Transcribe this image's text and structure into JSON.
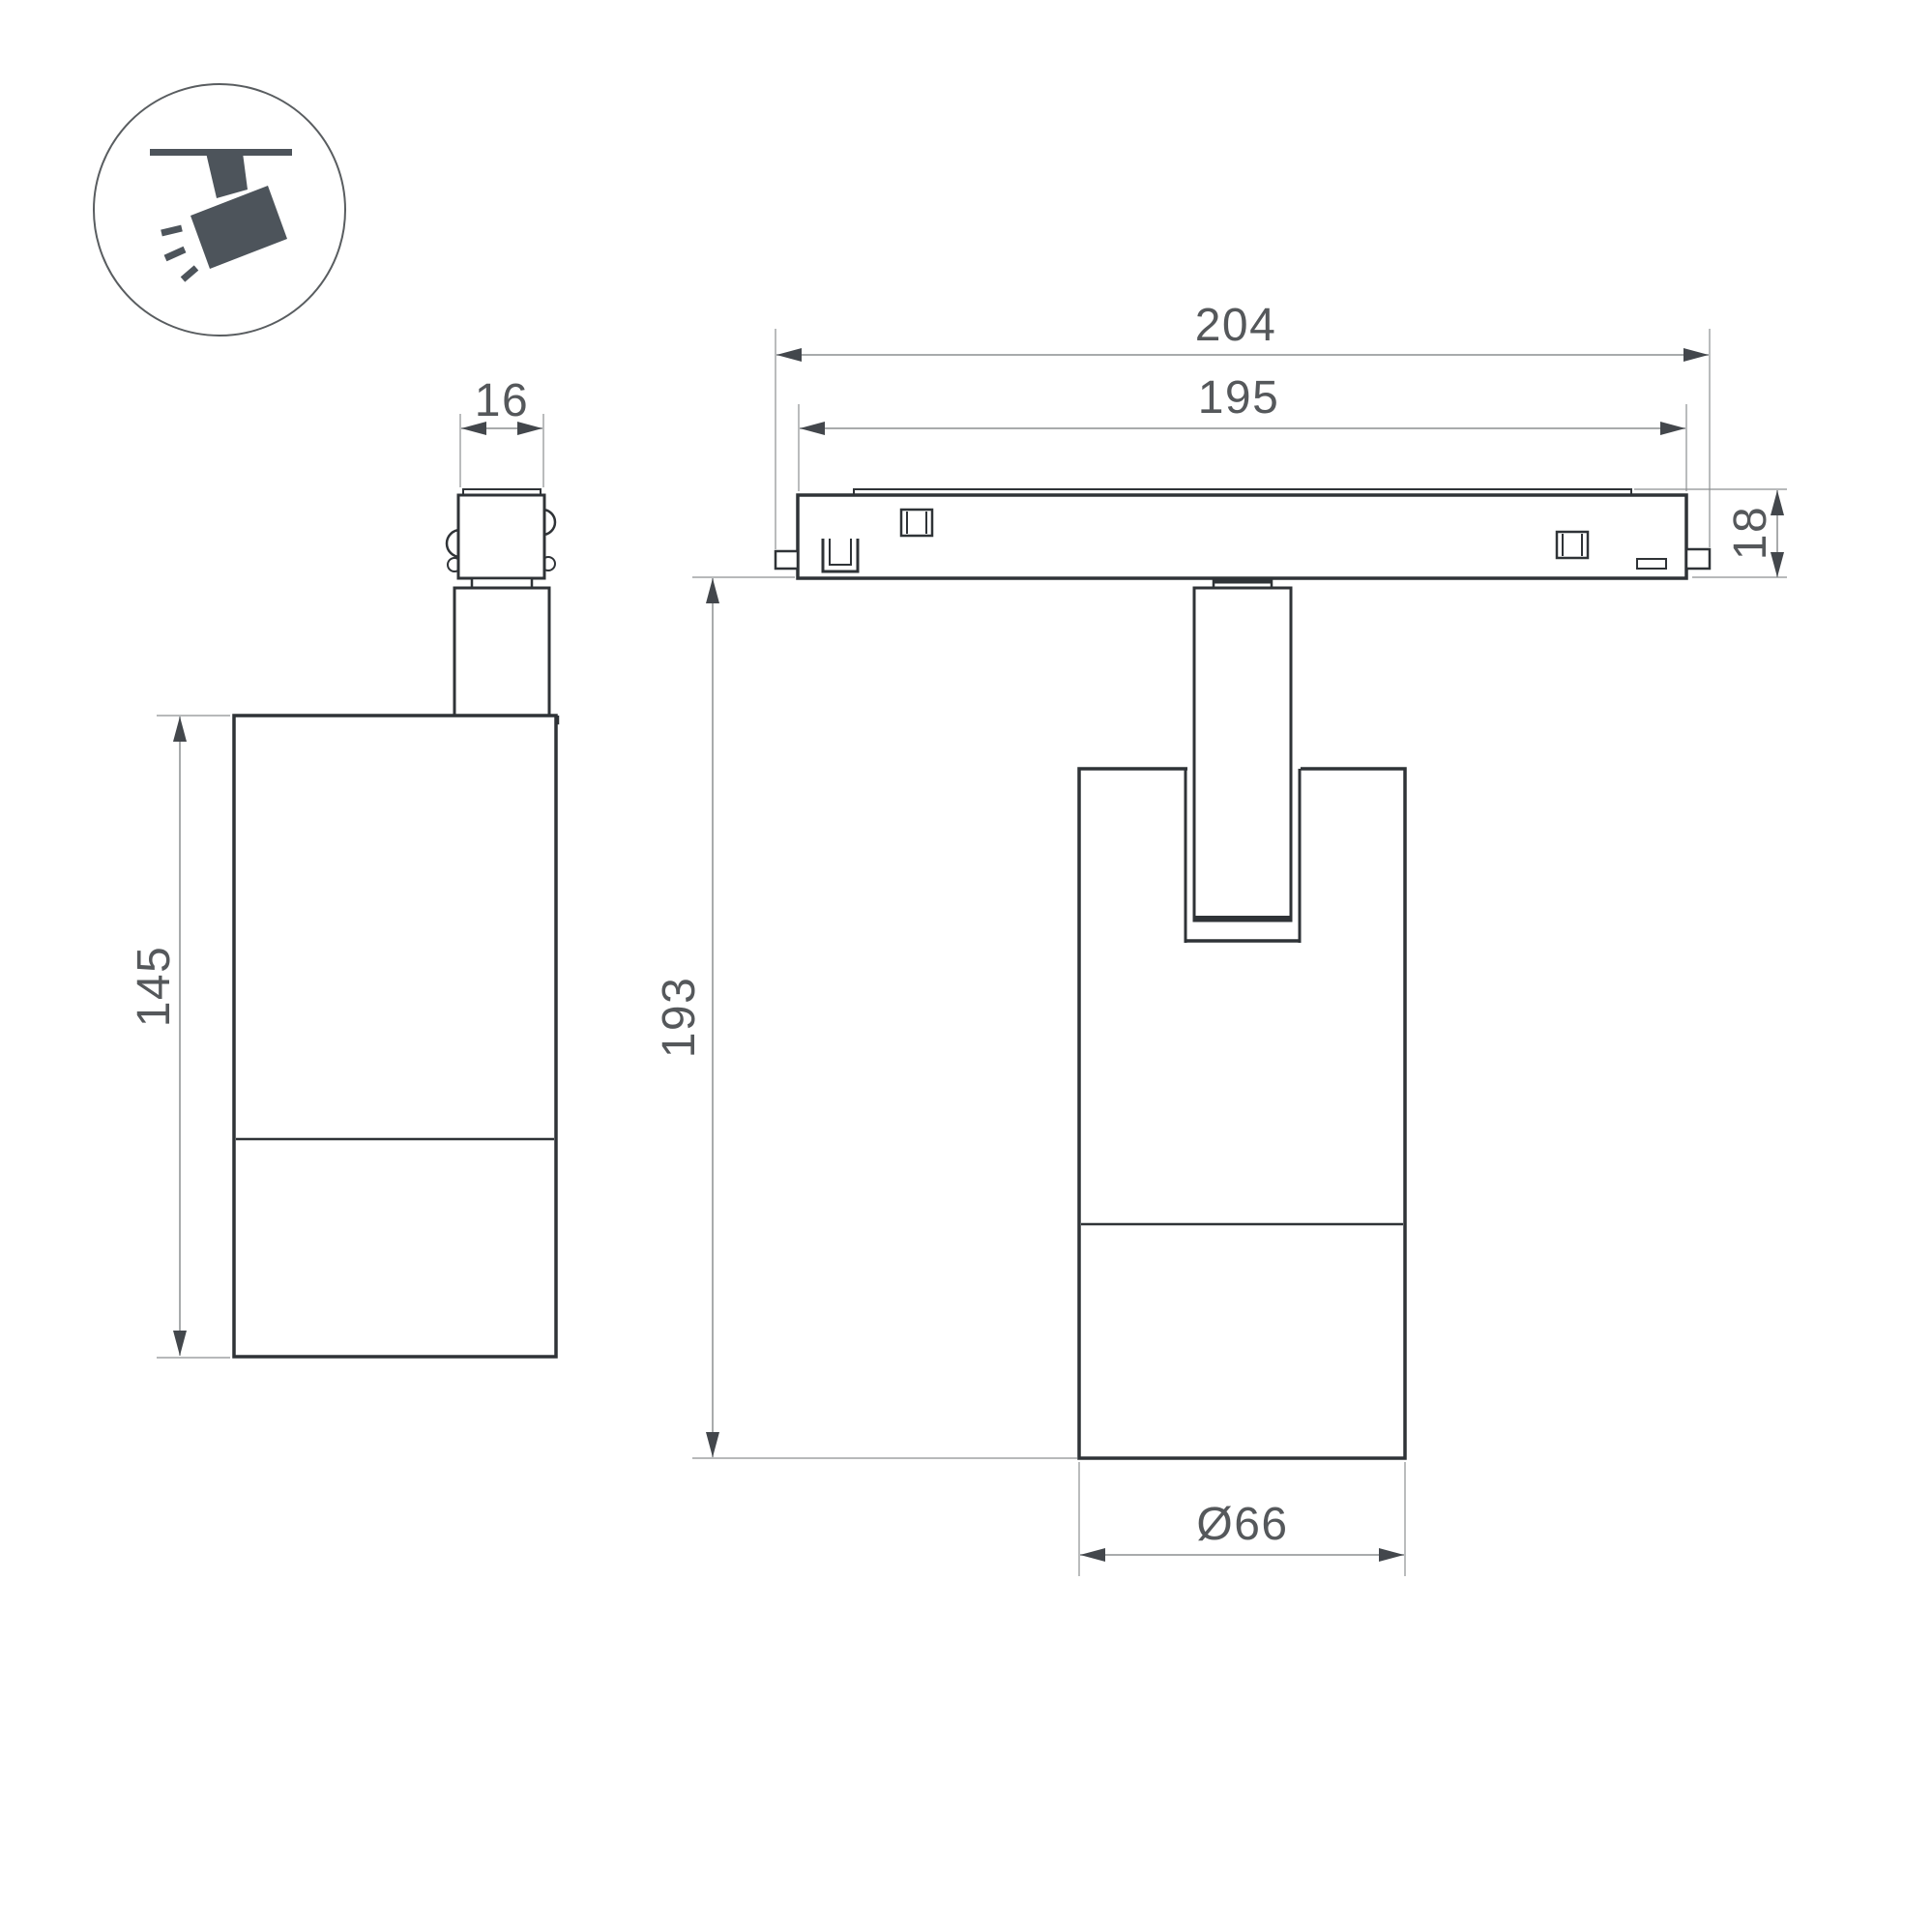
{
  "icon": "track-spotlight-icon",
  "dimensions": {
    "overall_width": "204",
    "body_width": "195",
    "adapter_width": "16",
    "track_height": "18",
    "overall_height": "193",
    "housing_height": "145",
    "housing_diameter": "Ø66"
  },
  "colors": {
    "outline": "#2f3337",
    "detail": "#33373a",
    "dimension": "#8c8f91",
    "arrow": "#43474c",
    "text": "#55585b",
    "icon": "#4d545b",
    "icon_circle": "#595d60",
    "background": "#ffffff"
  }
}
